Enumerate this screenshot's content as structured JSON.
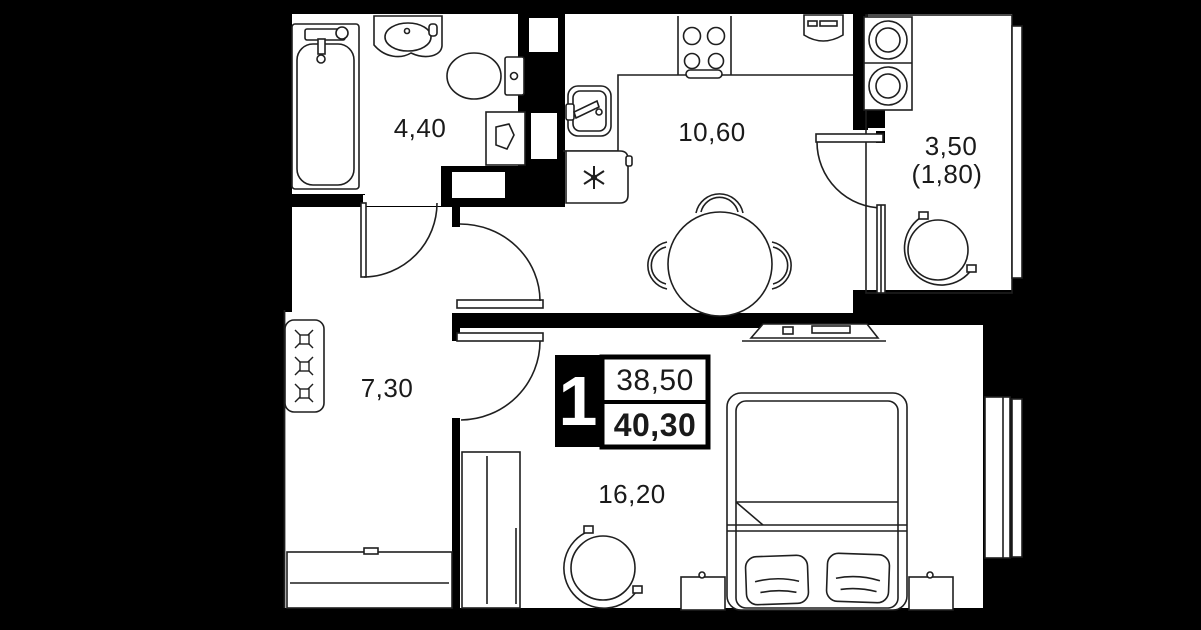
{
  "plan": {
    "title": "1-room apartment floor plan",
    "unit_badge": {
      "rooms": "1",
      "area_living": "38,50",
      "area_total": "40,30"
    },
    "rooms": {
      "bathroom": {
        "area": "4,40"
      },
      "kitchen": {
        "area": "10,60"
      },
      "balcony": {
        "area": "3,50",
        "area_reduced": "(1,80)"
      },
      "hallway": {
        "area": "7,30"
      },
      "living_room": {
        "area": "16,20"
      }
    },
    "colors": {
      "background": "#000000",
      "floor": "#ffffff",
      "walls": "#000000",
      "linework": "#1f1f1f"
    }
  }
}
